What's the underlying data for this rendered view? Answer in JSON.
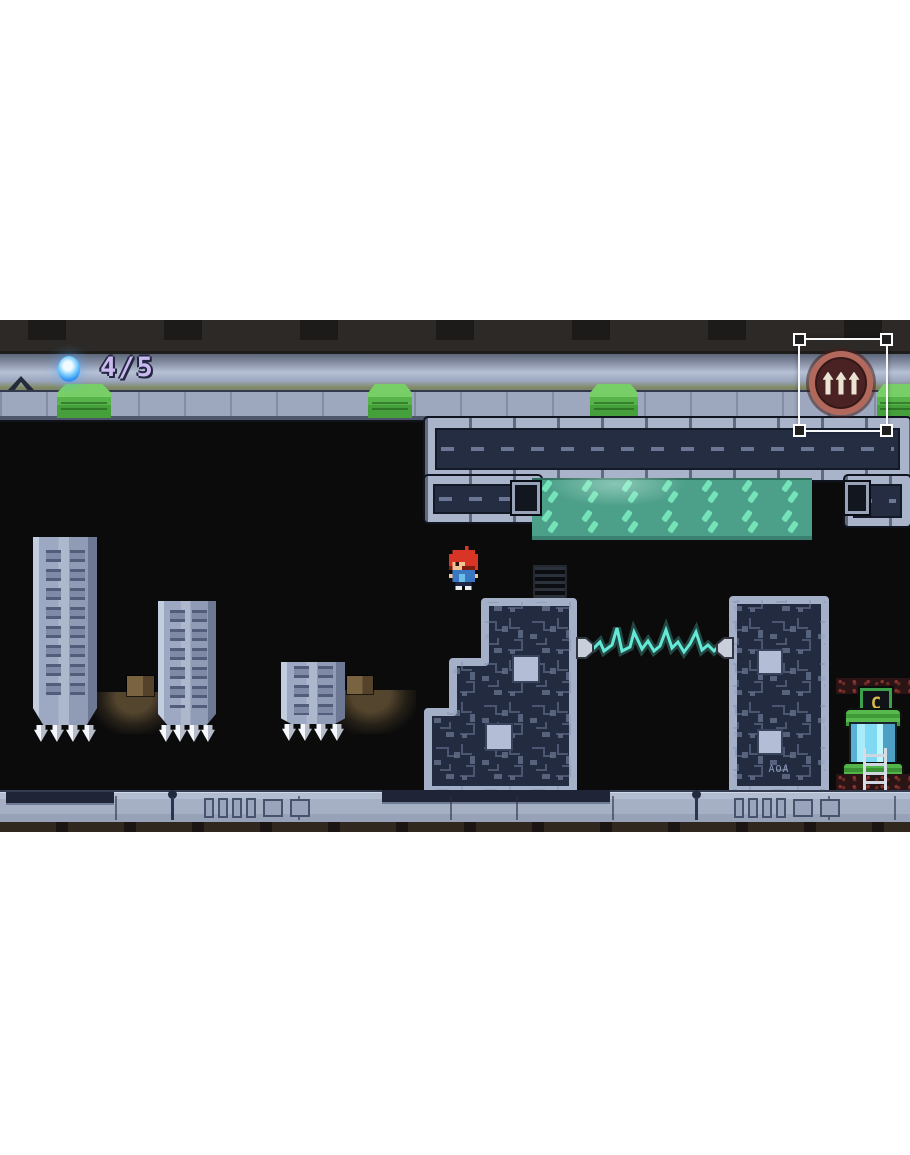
{
  "scene": {
    "type": "2d-platformer-level",
    "mode": "touch-control-layout-edit"
  },
  "hud": {
    "orb_icon": "energy-orb",
    "counter": "4/5"
  },
  "edit_overlay": {
    "selection": "jump-control-button",
    "button_icon": "triple-up-arrows"
  },
  "level": {
    "checkpoint_label": "C",
    "pillar_code": "AOA",
    "objects": {
      "grass_pads": 4,
      "spiked_crushers": 3,
      "circuit_pillars": 2,
      "electric_beams": 1,
      "vine_panels": 1,
      "checkpoint_capsules": 1,
      "wall_vents": 1,
      "dirt_lamps": 2
    }
  },
  "colors": {
    "hud_counter": "#cbbaf0",
    "orb_blue": "#55b8ff",
    "pad_green": "#55b148",
    "vine_teal": "#4c9f89",
    "leaf_mint": "#72e2b6",
    "beam_cyan": "#63e9d6",
    "metal_light": "#a9b4cb",
    "metal_dark": "#252d43",
    "button_ring": "#b2685a",
    "capsule_glass": "#8fe0f6"
  }
}
